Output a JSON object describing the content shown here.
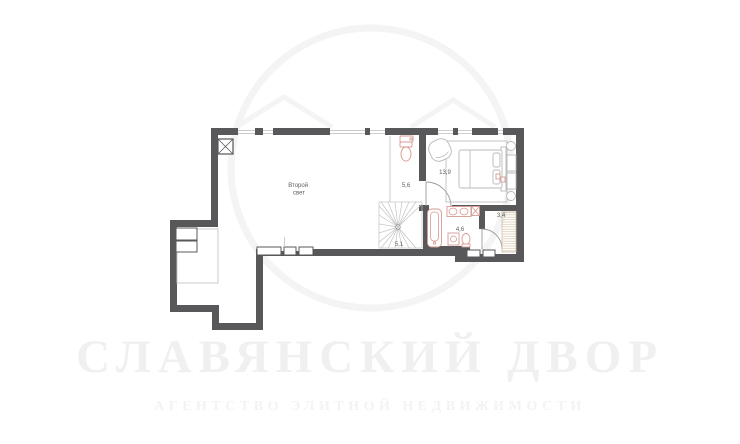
{
  "watermark": {
    "title": "СЛАВЯНСКИЙ ДВОР",
    "subtitle": "АГЕНТСТВО ЭЛИТНОЙ НЕДВИЖИМОСТИ"
  },
  "rooms": {
    "second_light": {
      "line1": "Второй",
      "line2": "свет"
    },
    "wc": {
      "area": "5,6"
    },
    "bedroom": {
      "area": "13,9"
    },
    "hall": {
      "area": "3,4"
    },
    "bathroom": {
      "area": "4,6"
    },
    "stairs": {
      "area": "5,1"
    }
  },
  "colors": {
    "wall": "#58585a",
    "plumbing_fixture": "#d89a93",
    "furniture_line": "#b8b8b8",
    "wardrobe_hatch": "#d8cbb5",
    "thin_line": "#c6c6c6",
    "label_text": "#5f5f5f",
    "watermark": "#f0f0f0",
    "background": "#ffffff"
  }
}
